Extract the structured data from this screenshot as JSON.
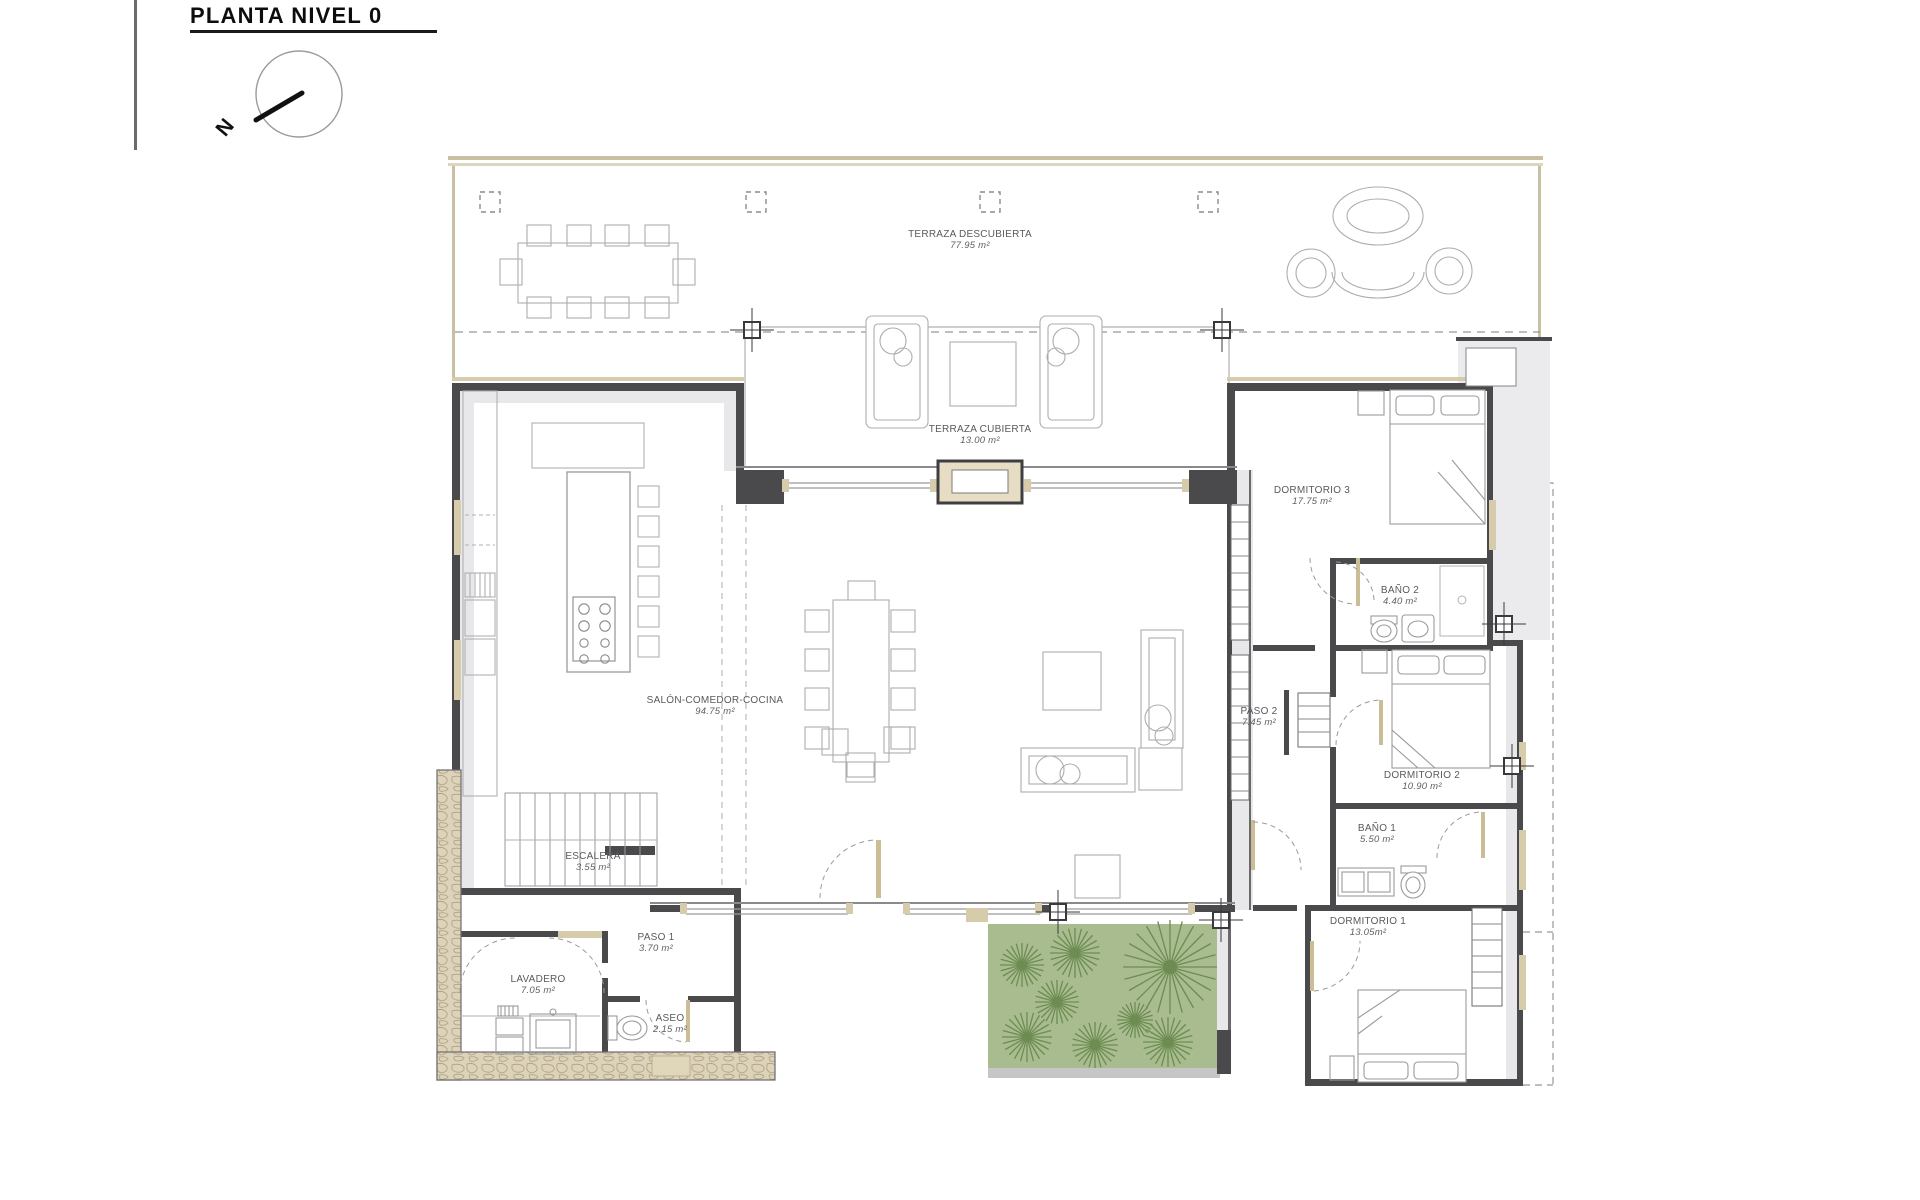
{
  "sheet": {
    "title": "PLANTA NIVEL 0"
  },
  "compass": {
    "label": "N"
  },
  "rooms": [
    {
      "name": "TERRAZA DESCUBIERTA",
      "area": "77.95 m²"
    },
    {
      "name": "TERRAZA CUBIERTA",
      "area": "13.00 m²"
    },
    {
      "name": "SALÓN-COMEDOR-COCINA",
      "area": "94.75 m²"
    },
    {
      "name": "DORMITORIO 3",
      "area": "17.75 m²"
    },
    {
      "name": "BAÑO 2",
      "area": "4.40 m²"
    },
    {
      "name": "PASO 2",
      "area": "7.45 m²"
    },
    {
      "name": "DORMITORIO 2",
      "area": "10.90 m²"
    },
    {
      "name": "BAÑO 1",
      "area": "5.50 m²"
    },
    {
      "name": "DORMITORIO 1",
      "area": "13.05m²"
    },
    {
      "name": "ESCALERA",
      "area": "3.55 m²"
    },
    {
      "name": "PASO 1",
      "area": "3.70 m²"
    },
    {
      "name": "LAVADERO",
      "area": "7.05 m²"
    },
    {
      "name": "ASEO",
      "area": "2.15 m²"
    }
  ],
  "colors": {
    "wall": "#4a4a4c",
    "tan": "#c9bfa1",
    "tan_light": "#d6cbab",
    "garden_bg": "#a9bc90",
    "plant": "#6d8c52",
    "poche": "#e8e8ea"
  }
}
